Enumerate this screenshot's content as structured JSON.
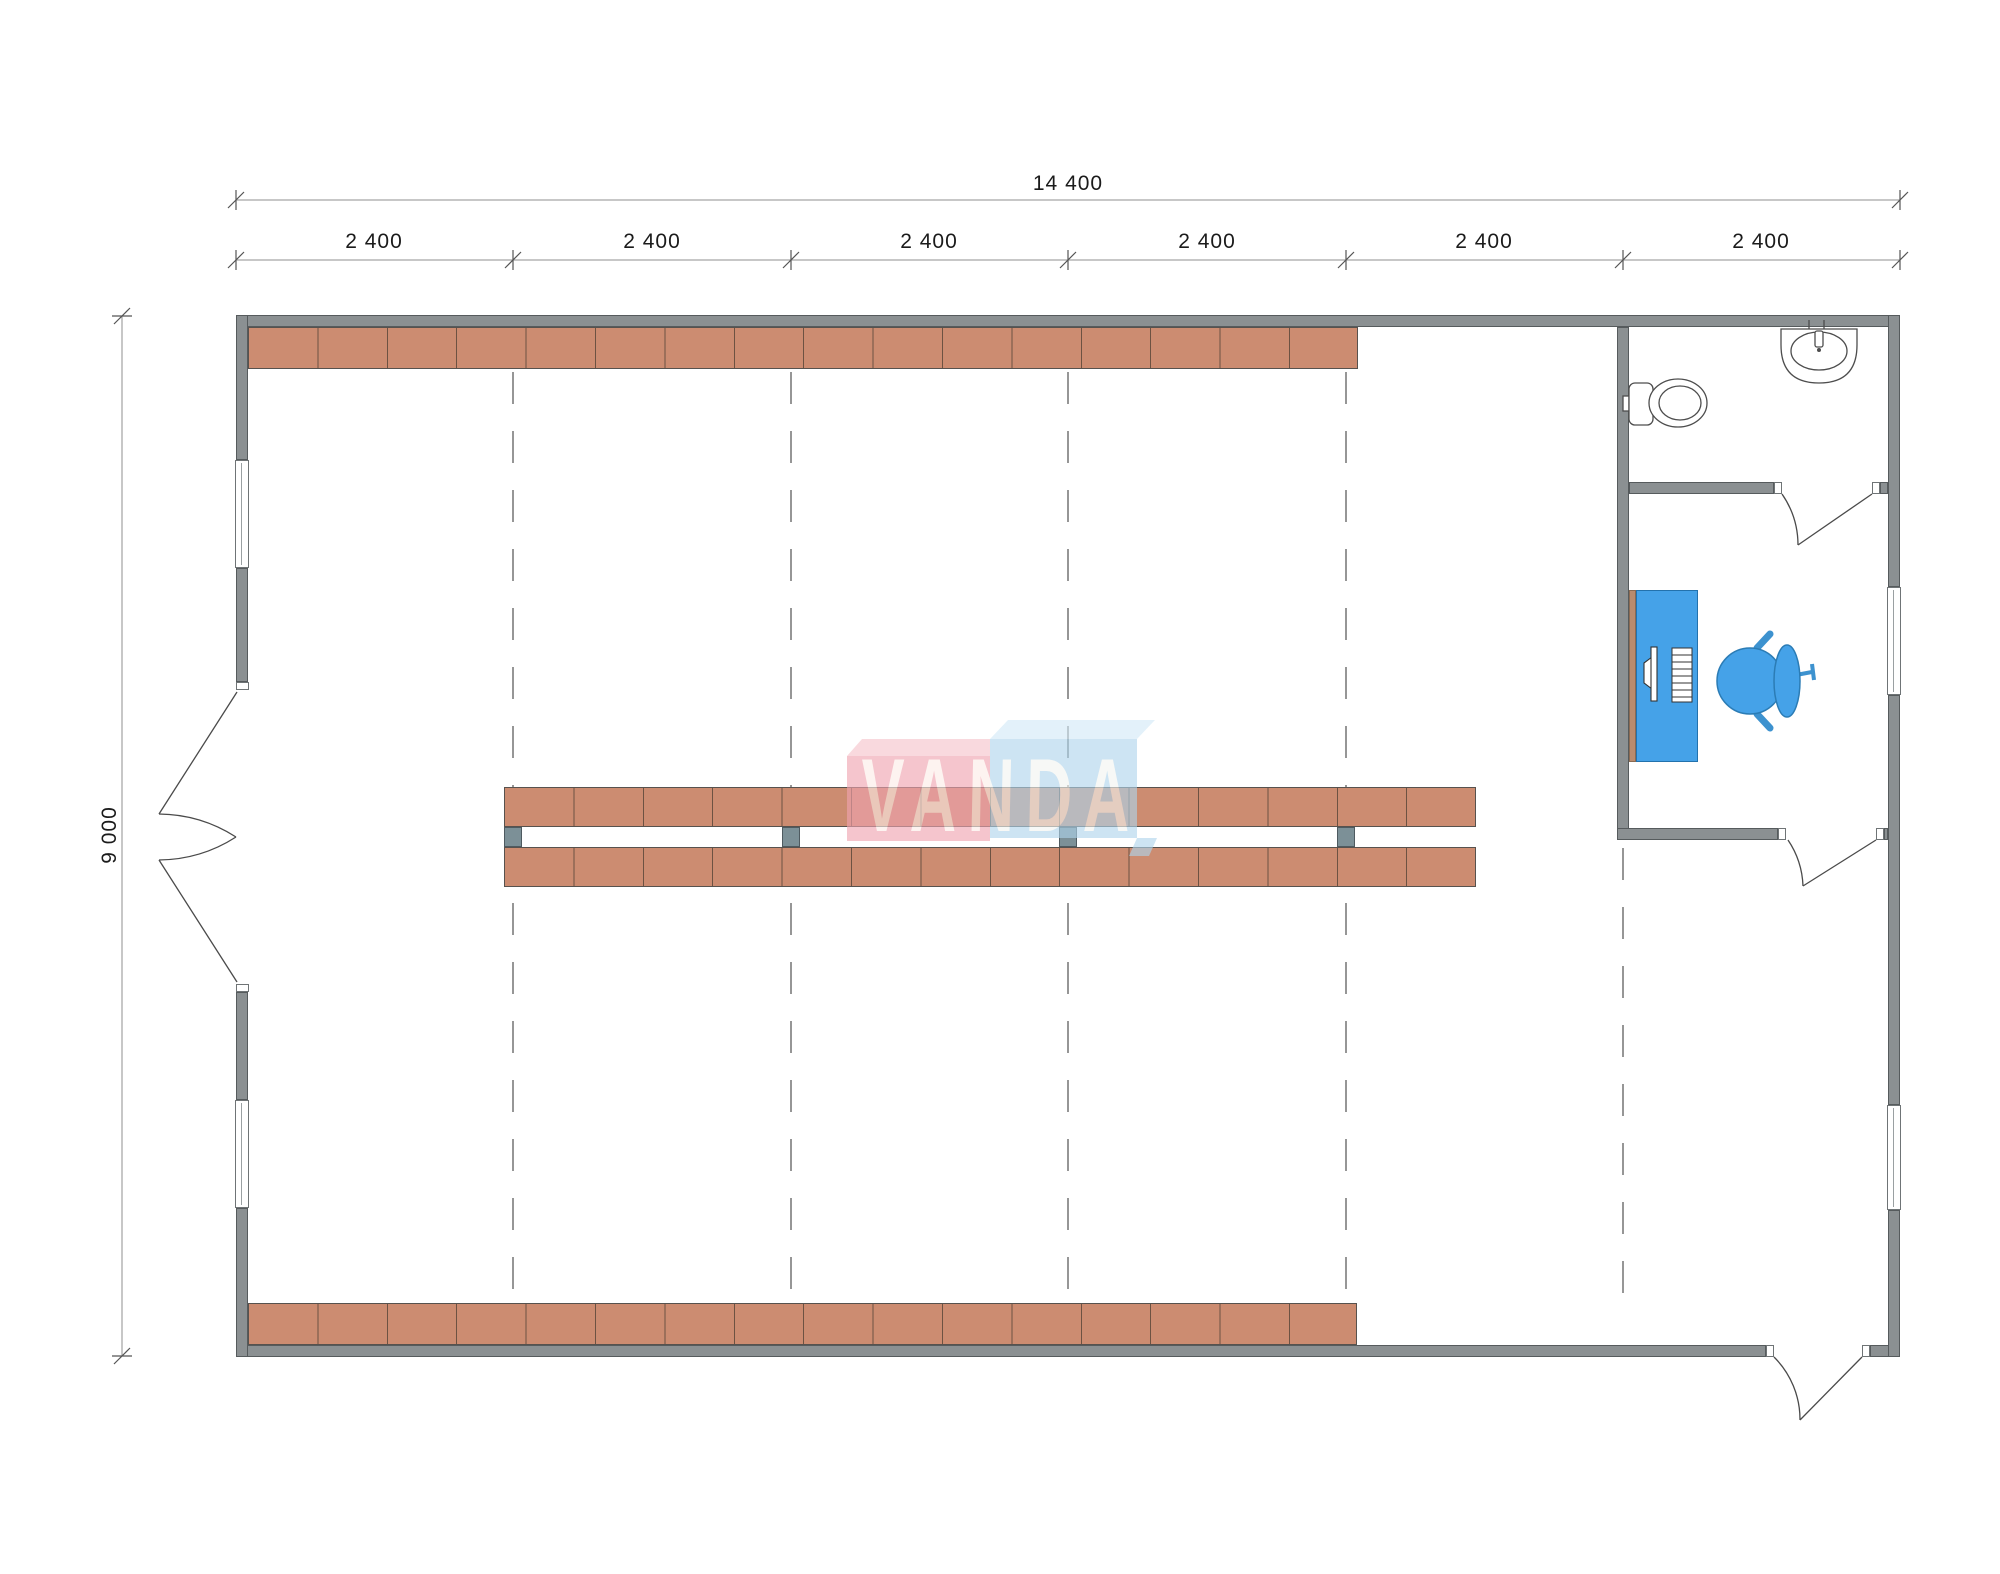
{
  "drawing": {
    "type": "floor-plan",
    "watermark_text": "VANDA"
  },
  "dimensions": {
    "total_width_label": "14 400",
    "height_label": "9 000",
    "segment_labels": [
      "2 400",
      "2 400",
      "2 400",
      "2 400",
      "2 400",
      "2 400"
    ]
  },
  "fixtures": {
    "bathroom": [
      "toilet-icon",
      "sink-icon"
    ],
    "office": [
      "desk-icon",
      "monitor-icon",
      "keyboard-icon",
      "office-chair-icon"
    ],
    "hall": [
      "shelf-rack-rows",
      "structural-columns"
    ]
  },
  "colors": {
    "wall": "#8b9092",
    "shelf": "#cc8c71",
    "column": "#7c9097",
    "furniture_blue": "#45a2e8",
    "watermark_pink": "#f0a3b0",
    "watermark_blue": "#afd5ec",
    "dimension_text": "#1b1b1b"
  }
}
